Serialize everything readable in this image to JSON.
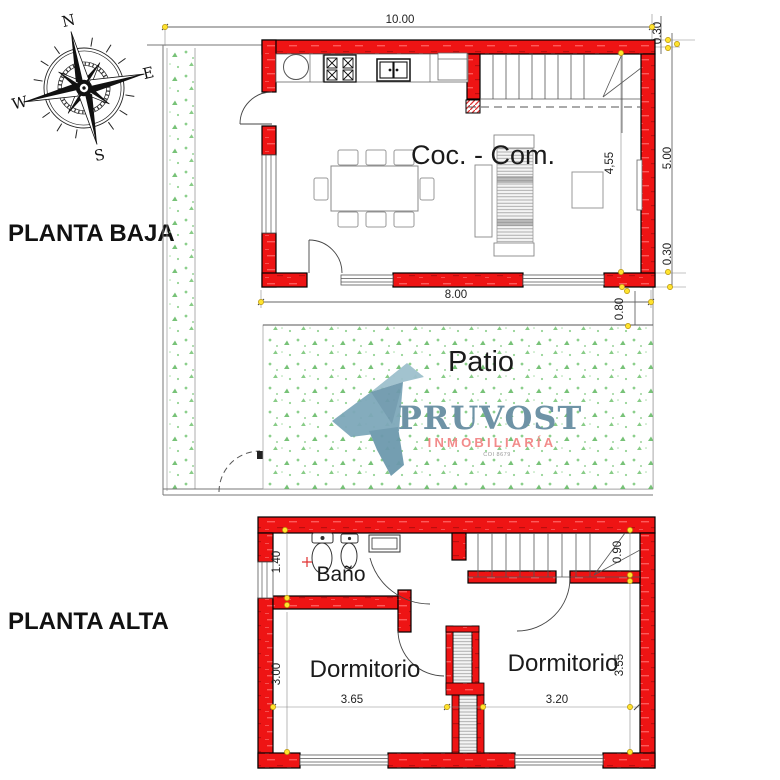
{
  "titles": {
    "planta_baja": "PLANTA BAJA",
    "planta_alta": "PLANTA ALTA"
  },
  "compass": {
    "north": "N",
    "east": "E",
    "west": "W",
    "south": "S"
  },
  "planta_baja": {
    "room_label": "Coc. - Com.",
    "patio_label": "Patio",
    "dim_top_width": "10.00",
    "dim_wall_top": "0.30",
    "dim_inner_height": "4,55",
    "dim_right_height": "5.00",
    "dim_wall_bottom": "0.30",
    "dim_bottom_width": "8.00",
    "dim_patio_offset": "0.80"
  },
  "planta_alta": {
    "bath_label": "Baño",
    "bedroom_left_label": "Dormitorio",
    "bedroom_right_label": "Dormitorio",
    "dim_bath_height": "1.40",
    "dim_stair_width": "0.90",
    "dim_bed_left_height": "3.00",
    "dim_bed_left_width": "3.65",
    "dim_bed_right_width": "3.20",
    "dim_bed_right_height": "3.55"
  },
  "logo": {
    "brand": "PRUVOST",
    "subtitle": "INMOBILIARÍA",
    "registration": "COI 8679"
  },
  "colors": {
    "wall_red": "#ee1414",
    "grass_green": "#6abf69",
    "brand_blue": "#6e93a6",
    "brand_salmon": "#f28b8b",
    "grip_yellow": "#ffe32e"
  }
}
